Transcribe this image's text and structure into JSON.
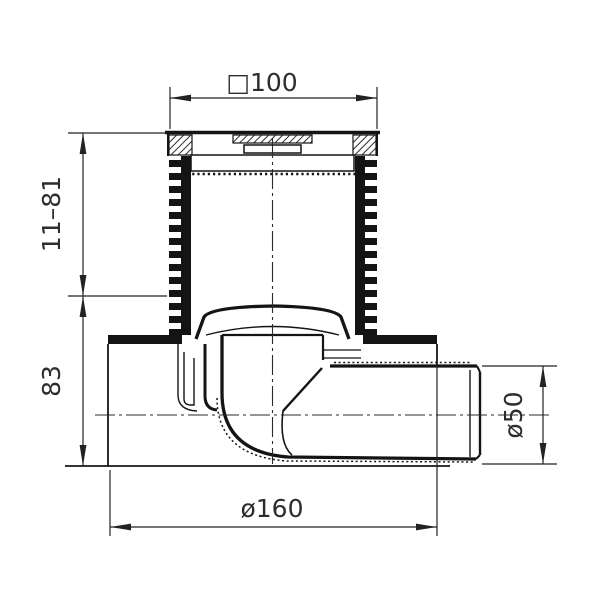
{
  "drawing": {
    "subject": "Floor drain with horizontal side outlet, sectional technical drawing",
    "background": "#ffffff",
    "line_color": "#141414"
  },
  "dimensions": {
    "grate_width": "□100",
    "height_adjust": "11–81",
    "body_height": "83",
    "base_diameter": "ø160",
    "outlet_diameter": "ø50"
  }
}
